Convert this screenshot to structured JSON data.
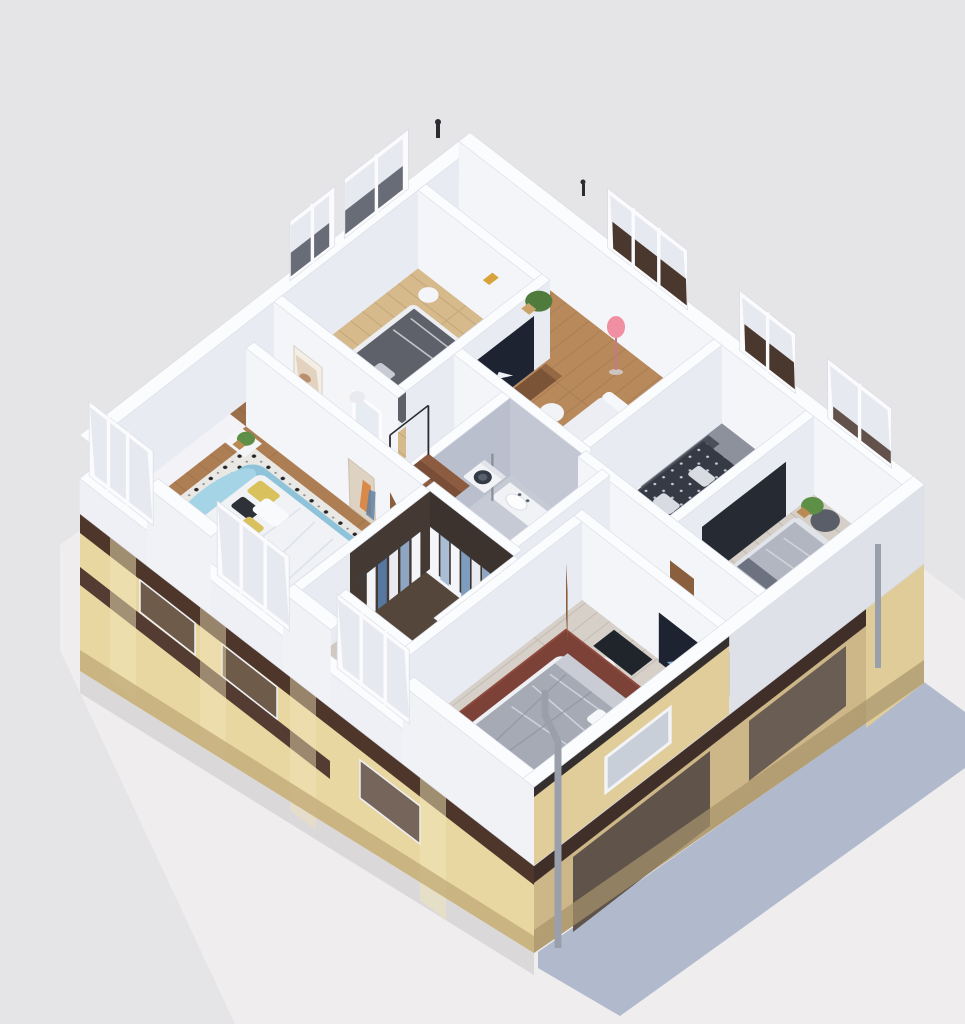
{
  "meta": {
    "type": "3d-floorplan-cutaway-render",
    "description": "Isometric dollhouse-style 3D render of a furnished apartment upper floor (bedrooms, living room, bathroom, walk-in closet) sitting on a beige classical facade with dark brown cornices, casting a blue-gray shadow on pale pavement"
  },
  "palette": {
    "background": "#e5e4e6",
    "paving": "#efedee",
    "cast_shadow": "#a9b4c8",
    "slab_white": "#f3f3f7",
    "facade_front": "#e9d7a2",
    "facade_side": "#cdb687",
    "trim_dark": "#4e362b",
    "trim_side": "#3f2f28",
    "attic_beige": "#e0cd9a",
    "wood_living": "#b8895b",
    "wood_bedroom_north": "#d6ba8c",
    "wood_bedroom_west": "#ad7e53",
    "wood_bedroom_south": "#d6d0c9",
    "wood_gray_planks": "#d5cfc8",
    "floor_blue_gray": "#8d919c",
    "wood_hall": "#9a6f49",
    "wood_hall_light": "#a97c50",
    "wood_hall_dark": "#6b4a38",
    "tile_bathroom": "#c6cad4",
    "balcony_gray": "#cfc9c2",
    "closet_floor": "#55463c",
    "rug_red": "#7c4137",
    "bed_teal": "#8fc3da",
    "pillow_yellow": "#d9c25e",
    "tv_dark": "#1d2330",
    "door_wood": "#8a5f3e",
    "plant_green": "#4f7c3d",
    "lamp_pink": "#ef8fa1",
    "pipe_gray": "#9aa0ab",
    "washer_white": "#f2f3f6",
    "sconce_amber": "#d9a33c"
  },
  "scene": {
    "rooms": [
      {
        "id": "bedroom-north",
        "features": [
          "gray double bed",
          "white pillows",
          "round side table",
          "floor plant",
          "two windows",
          "amber sconce"
        ]
      },
      {
        "id": "living-room",
        "features": [
          "white sofa",
          "walnut TV sideboard",
          "TV with paper plane",
          "pink floor lamp",
          "palm plant",
          "balcony doors with brown shutters"
        ]
      },
      {
        "id": "bedroom-east-small",
        "features": [
          "dark dotted bed",
          "upholstered headboard",
          "open clothes rail",
          "window with brown shutter"
        ]
      },
      {
        "id": "bedroom-east-corner",
        "features": [
          "gray rumpled bed",
          "round pouf",
          "dark nightstand with lamp",
          "wardrobe with clothes",
          "plant",
          "double windows"
        ]
      },
      {
        "id": "bathroom",
        "features": [
          "bathtub",
          "vanity sink",
          "toilet",
          "shower column",
          "towel shelf",
          "washing machine"
        ]
      },
      {
        "id": "laundry-nook",
        "features": [
          "washing machine",
          "staircase with dark railing"
        ]
      },
      {
        "id": "walk-in-closet",
        "features": [
          "hanging white and blue clothes",
          "dark shelving"
        ]
      },
      {
        "id": "bedroom-west",
        "features": [
          "teal curved headboard bed",
          "white duvet",
          "yellow and black pillows",
          "dotted tile rug",
          "nightstand with plant",
          "portrait art",
          "balcony glazing"
        ]
      },
      {
        "id": "bedroom-south",
        "features": [
          "bed with yellow pillows",
          "dark red rug",
          "desk nook with chair",
          "mountain artwork TV",
          "white nightstand",
          "balcony windows"
        ]
      }
    ],
    "exterior": [
      "beige pilaster facade",
      "dark mahogany cornice bands",
      "recessed dark window bays",
      "two gray drainpipes",
      "white floor slab rim",
      "roof vent pipes",
      "blue-gray cast shadow",
      "pale concrete plaza"
    ]
  }
}
